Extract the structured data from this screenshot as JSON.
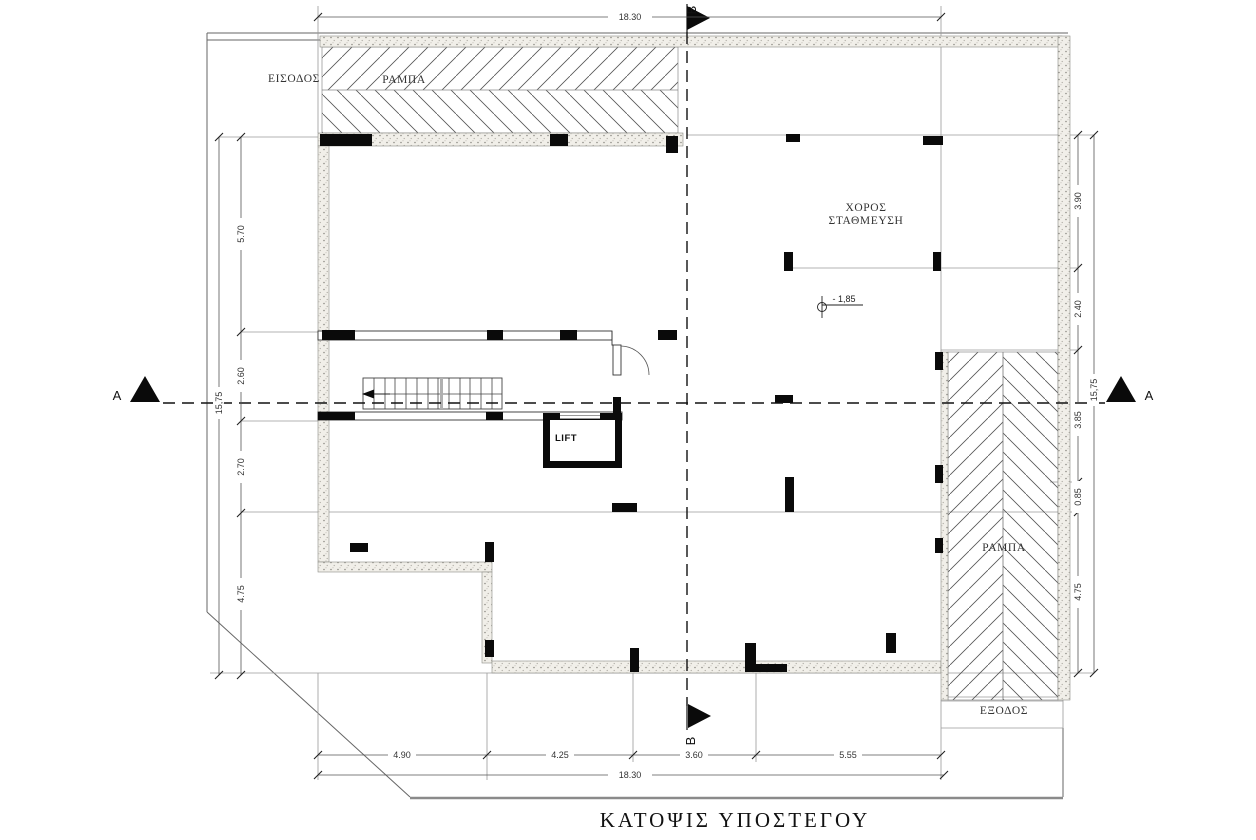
{
  "title": "ΚΑΤΟΨΙΣ ΥΠΟΣΤΕΓΟΥ",
  "rooms": {
    "parking_line1": "ΧΟΡΟΣ",
    "parking_line2": "ΣΤΑΘΜΕΥΣΗ",
    "lift": "LIFT"
  },
  "circulation": {
    "entrance": "ΕΙΣΟΔΟΣ",
    "exit": "ΕΞΟΔΟΣ",
    "ramp_top": "ΡΑΜΠΑ",
    "ramp_right": "ΡΑΜΠΑ"
  },
  "annotations": {
    "level": "- 1,85"
  },
  "sections": {
    "a": "A",
    "b": "B"
  },
  "dimensions": {
    "top": {
      "overall": "18.30"
    },
    "bottom": {
      "segments": [
        "4.90",
        "4.25",
        "3.60",
        "5.55"
      ],
      "overall": "18.30"
    },
    "left": {
      "segments": [
        "5.70",
        "2.60",
        "2.70",
        "4.75"
      ],
      "overall": "15,75"
    },
    "right": {
      "segments": [
        "3.90",
        "2.40",
        "3.85",
        "0.85",
        "4.75"
      ],
      "overall": "15,75"
    }
  },
  "colors": {
    "ink": "#0a0a0a",
    "grid": "#9a9a9a",
    "wall_fill": "#f1efe9",
    "dim_line": "#555555",
    "boundary": "#666666"
  }
}
